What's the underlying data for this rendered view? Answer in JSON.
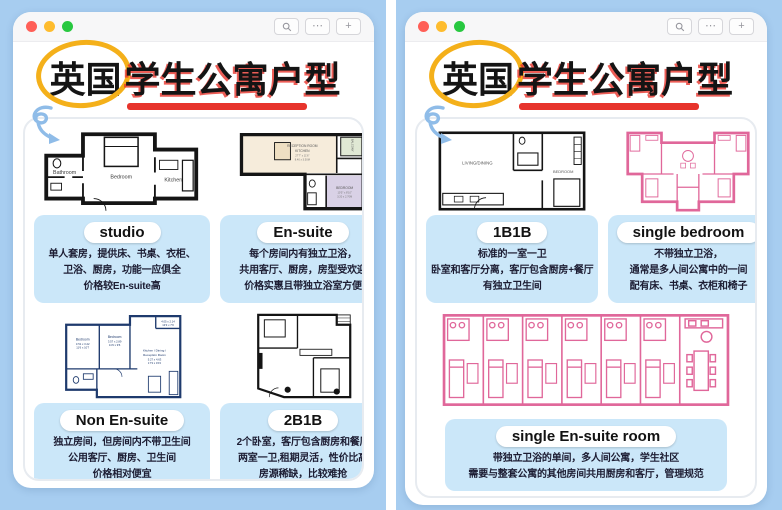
{
  "colors": {
    "background_blue": "#a7cdf0",
    "window_bg": "#ffffff",
    "chrome_bg": "#f7f7f8",
    "traffic_red": "#ff5f57",
    "traffic_yellow": "#febc2e",
    "traffic_green": "#28c840",
    "card_blue": "#cbe7f9",
    "title_black": "#141414",
    "underline_red": "#e7342c",
    "circle_yellow": "#f4b01a",
    "arrow_blue": "#8fbce8",
    "navy_plan": "#1e3a6d",
    "pink_plan": "#e0679a"
  },
  "chrome": {
    "more_label": "⋯",
    "new_tab_label": "+",
    "search_icon": "magnifier"
  },
  "title": {
    "circled": "英国",
    "rest": "学生公寓户型"
  },
  "windows": [
    {
      "name": "left",
      "cells": [
        {
          "label": "studio",
          "lines": [
            "单人套房，提供床、书桌、衣柜、",
            "卫浴、厨房，功能一应俱全",
            "价格较En-suite高"
          ]
        },
        {
          "label": "En-suite",
          "lines": [
            "每个房间内有独立卫浴，",
            "共用客厅、厨房，房型受欢迎",
            "价格实惠且带独立浴室方便"
          ]
        },
        {
          "label": "Non En-suite",
          "lines": [
            "独立房间，但房间内不带卫生间",
            "公用客厅、厨房、卫生间",
            "价格相对便宜"
          ]
        },
        {
          "label": "2B1B",
          "lines": [
            "2个卧室，客厅包含厨房和餐厅",
            "两室一卫,租期灵活，性价比高",
            "房源稀缺，比较难抢"
          ]
        }
      ]
    },
    {
      "name": "right",
      "cells": [
        {
          "label": "1B1B",
          "lines": [
            "标准的一室一卫",
            "卧室和客厅分离，客厅包含厨房+餐厅",
            "有独立卫生间"
          ]
        },
        {
          "label": "single  bedroom",
          "lines": [
            "不带独立卫浴，",
            "通常是多人间公寓中的一间",
            "配有床、书桌、衣柜和椅子"
          ]
        },
        {
          "label": "single En-suite room",
          "lines": [
            "带独立卫浴的单间，多人间公寓，学生社区",
            "需要与整套公寓的其他房间共用厨房和客厅，管理规范"
          ]
        }
      ]
    }
  ],
  "floorplans": {
    "studio": {
      "bathroom": "Bathroom",
      "bedroom": "Bedroom",
      "kitchen": "Kitchen"
    },
    "en_suite": {
      "reception_line1": "RECEPTION ROOM",
      "reception_line2": "KITCHEN",
      "reception_dims1": "27'7\" x 11'6\"",
      "reception_dims2": "8.40 x 3.50M",
      "bedroom": "BEDROOM",
      "bedroom_dims1": "10'5\" x 8'10\"",
      "bedroom_dims2": "3.20 x 2.70M",
      "balcony": "BALCONY"
    },
    "non_en_suite": {
      "bedroom1": "Bedroom",
      "bedroom1_dims1": "3.51 x 3.22",
      "bedroom1_dims2": "11'6 x 10'7",
      "bedroom2": "Bedroom",
      "bedroom2_dims1": "3.57 x 2.89",
      "bedroom2_dims2": "11'9 x 9'6",
      "kitchen_line1": "Kitchen / Dining /",
      "kitchen_line2": "Reception Room",
      "kitchen_dims1": "5.27 x 4.63",
      "kitchen_dims2": "17'3 x 15'2",
      "top_dims1": "4.05 x 2.14",
      "top_dims2": "13'3 x 7'0"
    },
    "one_b_one_b": {
      "living": "LIVING/DINING",
      "bedroom": "BEDROOM"
    }
  }
}
